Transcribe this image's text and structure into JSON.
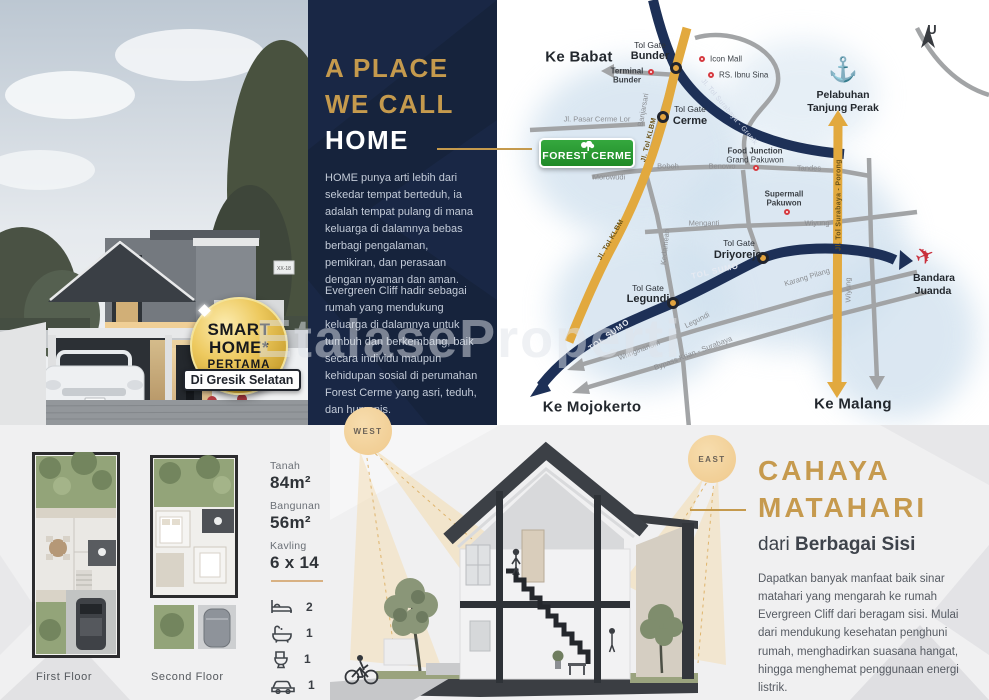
{
  "watermark": "EtalaseProperti",
  "hero": {
    "badge": {
      "line1": "SMART",
      "line2": "HOME*",
      "line3": "PERTAMA",
      "banner": "Di Gresik Selatan"
    },
    "house_number": "XX-18"
  },
  "intro": {
    "title1": "A PLACE",
    "title2": "WE CALL",
    "title3": "HOME",
    "para1": "HOME punya arti lebih dari sekedar tempat berteduh, ia adalah tempat pulang di mana keluarga di dalamnya bebas berbagi pengalaman, pemikiran, dan perasaan dengan nyaman dan aman.",
    "para2": "Evergreen Cliff hadir sebagai rumah yang mendukung keluarga di dalamnya untuk tumbuh dan berkembang, baik secara individu maupun kehidupan sosial di perumahan Forest Cerme yang asri, teduh, dan humanis."
  },
  "map": {
    "compass_label": "U",
    "logo_text": "FOREST CERME",
    "anchor_poi": "Pelabuhan Tanjung Perak",
    "plane_poi": "Bandara Juanda",
    "labels": [
      {
        "t": "Ke Babat",
        "x": 82,
        "y": 57,
        "c": "dest"
      },
      {
        "t": "Ke Mojokerto",
        "x": 95,
        "y": 407,
        "c": "dest"
      },
      {
        "t": "Ke Malang",
        "x": 356,
        "y": 404,
        "c": "dest"
      },
      {
        "t": "Tol Gate",
        "x": 153,
        "y": 45,
        "c": "gatetop"
      },
      {
        "t": "Bunder",
        "x": 153,
        "y": 56,
        "c": "gatename"
      },
      {
        "t": "Tol Gate",
        "x": 193,
        "y": 109,
        "c": "gatetop"
      },
      {
        "t": "Cerme",
        "x": 193,
        "y": 121,
        "c": "gatename"
      },
      {
        "t": "Tol Gate",
        "x": 242,
        "y": 243,
        "c": "gatetop"
      },
      {
        "t": "Driyorejo",
        "x": 241,
        "y": 255,
        "c": "gatename"
      },
      {
        "t": "Tol Gate",
        "x": 151,
        "y": 288,
        "c": "gatetop"
      },
      {
        "t": "Legundi",
        "x": 151,
        "y": 299,
        "c": "gatename"
      },
      {
        "t": "Terminal",
        "x": 130,
        "y": 71,
        "c": "poib"
      },
      {
        "t": "Bunder",
        "x": 130,
        "y": 80,
        "c": "poib"
      },
      {
        "t": "Icon Mall",
        "x": 213,
        "y": 59,
        "c": "poi-l"
      },
      {
        "t": "RS. Ibnu Sina",
        "x": 222,
        "y": 75,
        "c": "poi-l"
      },
      {
        "t": "Food Junction",
        "x": 258,
        "y": 151,
        "c": "poib"
      },
      {
        "t": "Grand Pakuwon",
        "x": 258,
        "y": 160,
        "c": "poi"
      },
      {
        "t": "Supermall",
        "x": 287,
        "y": 194,
        "c": "poib"
      },
      {
        "t": "Pakuwon",
        "x": 287,
        "y": 203,
        "c": "poib"
      },
      {
        "t": "Pelabuhan",
        "x": 346,
        "y": 95,
        "c": "poib2"
      },
      {
        "t": "Tanjung Perak",
        "x": 346,
        "y": 108,
        "c": "poib2"
      },
      {
        "t": "Bandara",
        "x": 437,
        "y": 278,
        "c": "poib2"
      },
      {
        "t": "Juanda",
        "x": 436,
        "y": 291,
        "c": "poib2"
      },
      {
        "t": "Jl. Pasar Cerme Lor",
        "x": 100,
        "y": 119,
        "c": "road"
      },
      {
        "t": "Morowudi",
        "x": 112,
        "y": 177,
        "c": "road"
      },
      {
        "t": "Boboh",
        "x": 171,
        "y": 166,
        "c": "road"
      },
      {
        "t": "Benowo",
        "x": 225,
        "y": 166,
        "c": "road"
      },
      {
        "t": "Tandes",
        "x": 312,
        "y": 168,
        "c": "road"
      },
      {
        "t": "Menganti",
        "x": 207,
        "y": 223,
        "c": "road"
      },
      {
        "t": "Wiyung",
        "x": 320,
        "y": 223,
        "c": "road"
      },
      {
        "t": "Banjarsari",
        "x": 146,
        "y": 110,
        "c": "road",
        "r": -80
      },
      {
        "t": "Kedamean",
        "x": 168,
        "y": 247,
        "c": "road",
        "r": -84
      },
      {
        "t": "Legundi",
        "x": 200,
        "y": 320,
        "c": "road",
        "r": -27
      },
      {
        "t": "Wringinanom",
        "x": 142,
        "y": 350,
        "c": "road",
        "r": -21
      },
      {
        "t": "Bypass Krian - Surabaya",
        "x": 196,
        "y": 353,
        "c": "road",
        "r": -21
      },
      {
        "t": "Karang Pilang",
        "x": 310,
        "y": 277,
        "c": "road",
        "r": -17
      },
      {
        "t": "Wiyung",
        "x": 351,
        "y": 290,
        "c": "road",
        "r": -90
      },
      {
        "t": "Jl. Tol KLBM",
        "x": 152,
        "y": 140,
        "c": "onyellow",
        "r": -76
      },
      {
        "t": "Jl. Tol KLBM",
        "x": 114,
        "y": 240,
        "c": "onyellow",
        "r": -60
      },
      {
        "t": "Jl. Tol Surabaya - Gresik",
        "x": 232,
        "y": 112,
        "c": "onnavy",
        "r": 50
      },
      {
        "t": "Jl. Tol Surabaya - Porong",
        "x": 342,
        "y": 205,
        "c": "onyellow",
        "r": -90
      },
      {
        "t": "TOL SUMO",
        "x": 218,
        "y": 271,
        "c": "onnavy2",
        "r": -13
      },
      {
        "t": "TOL SUMO",
        "x": 112,
        "y": 335,
        "c": "onnavy2",
        "r": -36
      }
    ],
    "gate_markers": [
      {
        "x": 179,
        "y": 68
      },
      {
        "x": 166,
        "y": 117
      },
      {
        "x": 266,
        "y": 258
      },
      {
        "x": 176,
        "y": 303
      }
    ],
    "poi_markers": [
      {
        "x": 154,
        "y": 72
      },
      {
        "x": 205,
        "y": 59
      },
      {
        "x": 214,
        "y": 75
      },
      {
        "x": 259,
        "y": 168
      },
      {
        "x": 290,
        "y": 212
      }
    ]
  },
  "plans": {
    "first": "First Floor",
    "second": "Second Floor"
  },
  "specs": {
    "items": [
      {
        "label": "Tanah",
        "value": "84m²"
      },
      {
        "label": "Bangunan",
        "value": "56m²"
      },
      {
        "label": "Kavling",
        "value": "6 x 14"
      }
    ],
    "features": [
      {
        "name": "bed",
        "count": "2"
      },
      {
        "name": "bathtub",
        "count": "1"
      },
      {
        "name": "toilet",
        "count": "1"
      },
      {
        "name": "car",
        "count": "1"
      }
    ]
  },
  "sunlight": {
    "west": "WEST",
    "east": "EAST",
    "title1": "CAHAYA",
    "title2": "MATAHARI",
    "subtitle_regular": "dari",
    "subtitle_bold": "Berbagai Sisi",
    "para": "Dapatkan banyak manfaat baik sinar matahari yang mengarah ke rumah Evergreen Cliff dari beragam sisi. Mulai dari mendukung kesehatan penghuni rumah, menghadirkan suasana hangat, hingga menghemat penggunaan energi listrik."
  }
}
